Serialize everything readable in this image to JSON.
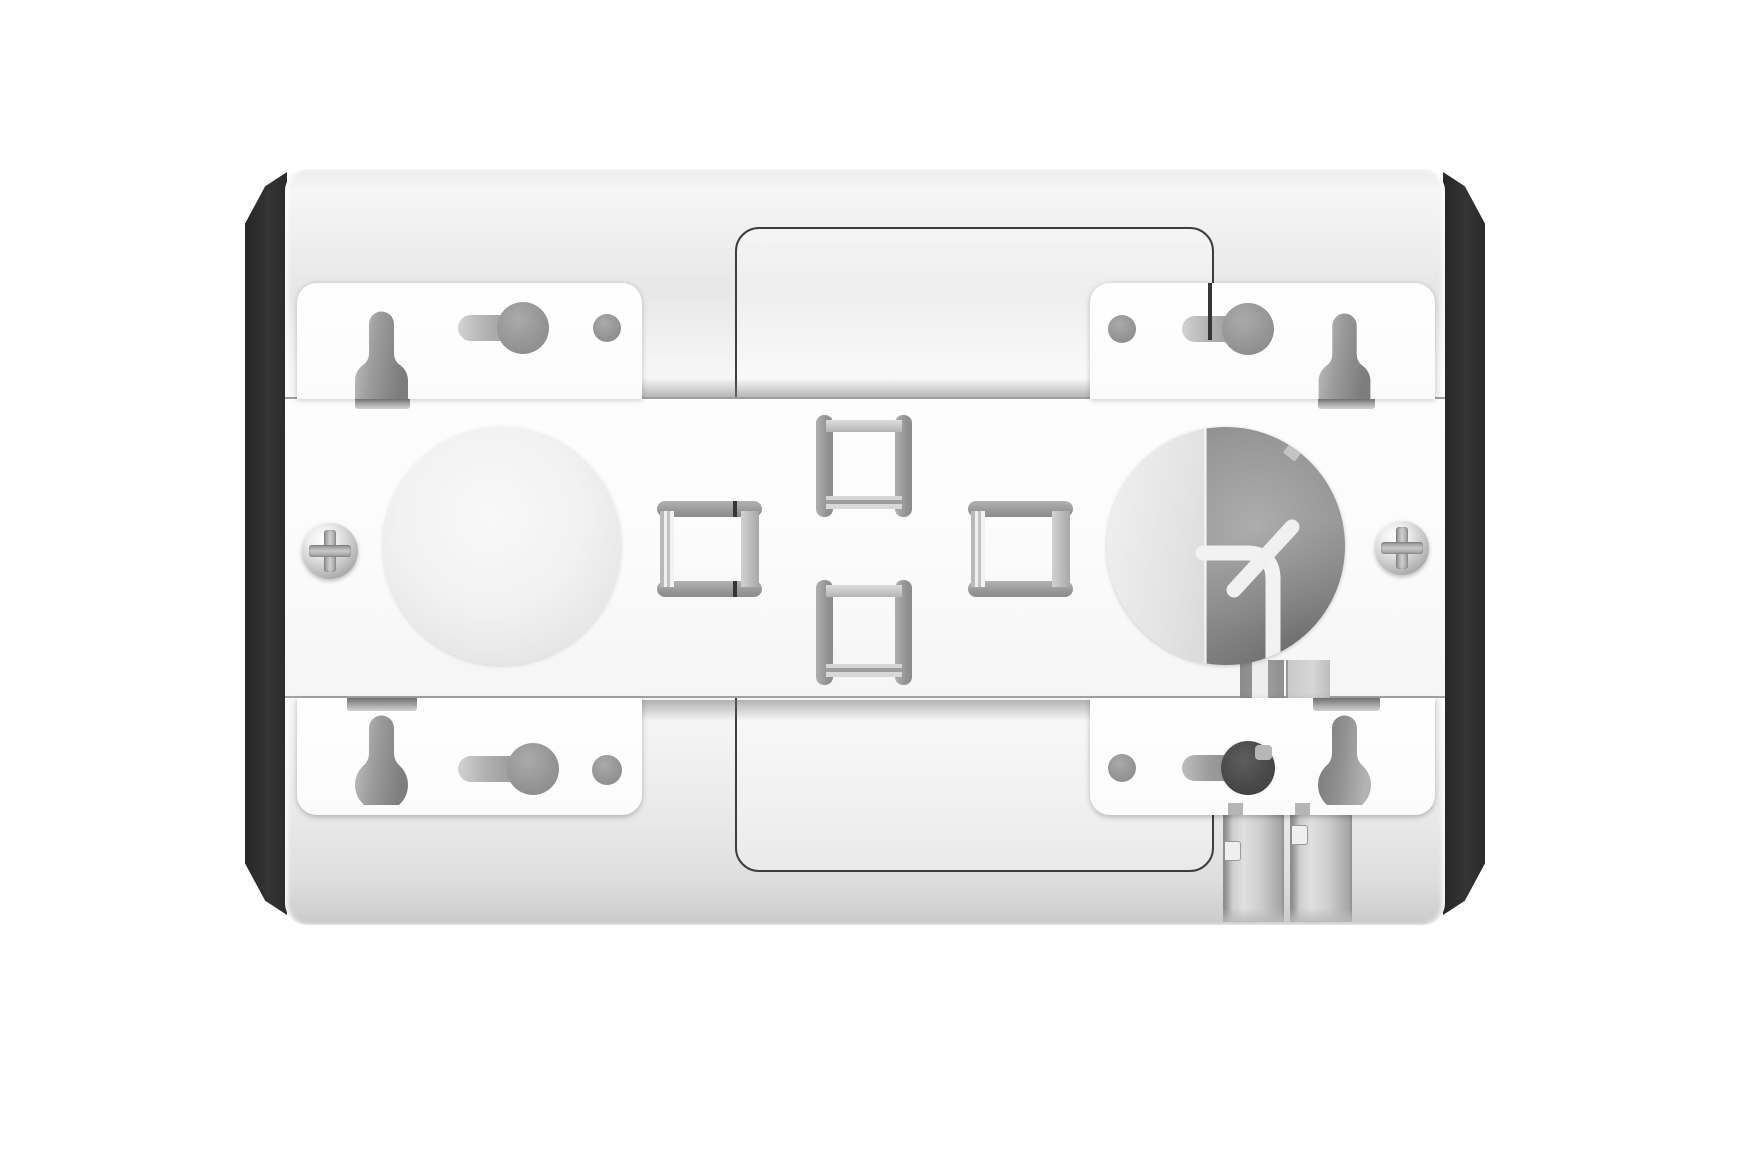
{
  "meta": {
    "kind": "product-render",
    "description": "Rear mounting view of a white rectangular device with black rubber end caps, four wall-mount bracket tabs with keyhole slots, two circular knockouts (one open with a routed white cable), four cable-tie clips, two side screws and bottom cable channels.",
    "background_color": "#ffffff"
  },
  "colors": {
    "background": "#ffffff",
    "body_light": "#fcfcfc",
    "body_shade": "#dedede",
    "end_cap_black": "#2e2e2e",
    "band_white": "#fbfbfb",
    "band_edge_line": "#a0a0a0",
    "bracket_white": "#fefefe",
    "panel_outline": "#3e3e3e",
    "hole_gray": "#999999",
    "keyhole_dark": "#474747",
    "dome_fill": "#f0f0f0",
    "cavity_gray": "#8f8f8f",
    "cavity_lid": "#e6e6e6",
    "cable_white": "#f2f2f2",
    "clip_cap_gray": "#9c9c9c",
    "clip_rail_light": "#d0d0d0",
    "screw_metal": "#c6c6c6",
    "channel_gray": "#c9c9c9"
  },
  "parts": {
    "device": "device rear housing",
    "end_cap_left": "left rubber end cap",
    "end_cap_right": "right rubber end cap",
    "access_panel": "rear access panel outline",
    "mounting_band": "central mounting plate band",
    "bracket_top_left": "top-left wall-mount bracket tab",
    "bracket_top_right": "top-right wall-mount bracket tab",
    "bracket_bottom_left": "bottom-left wall-mount bracket tab",
    "bracket_bottom_right": "bottom-right wall-mount bracket tab",
    "keyhole_slot": "keyhole screw slot",
    "anchor_cutout": "anchor bottle cutout",
    "pilot_hole": "round pilot hole",
    "knockout_dome": "left circular knockout dome",
    "cable_opening": "right circular cable opening",
    "routed_cable": "routed white cable with junction",
    "cable_clip": "cable tie clip loop",
    "screw_left": "left phillips screw",
    "screw_right": "right phillips screw",
    "cable_channel_inner": "inner cable exit channel",
    "cable_channel_outer": "outer cable exit channel"
  }
}
